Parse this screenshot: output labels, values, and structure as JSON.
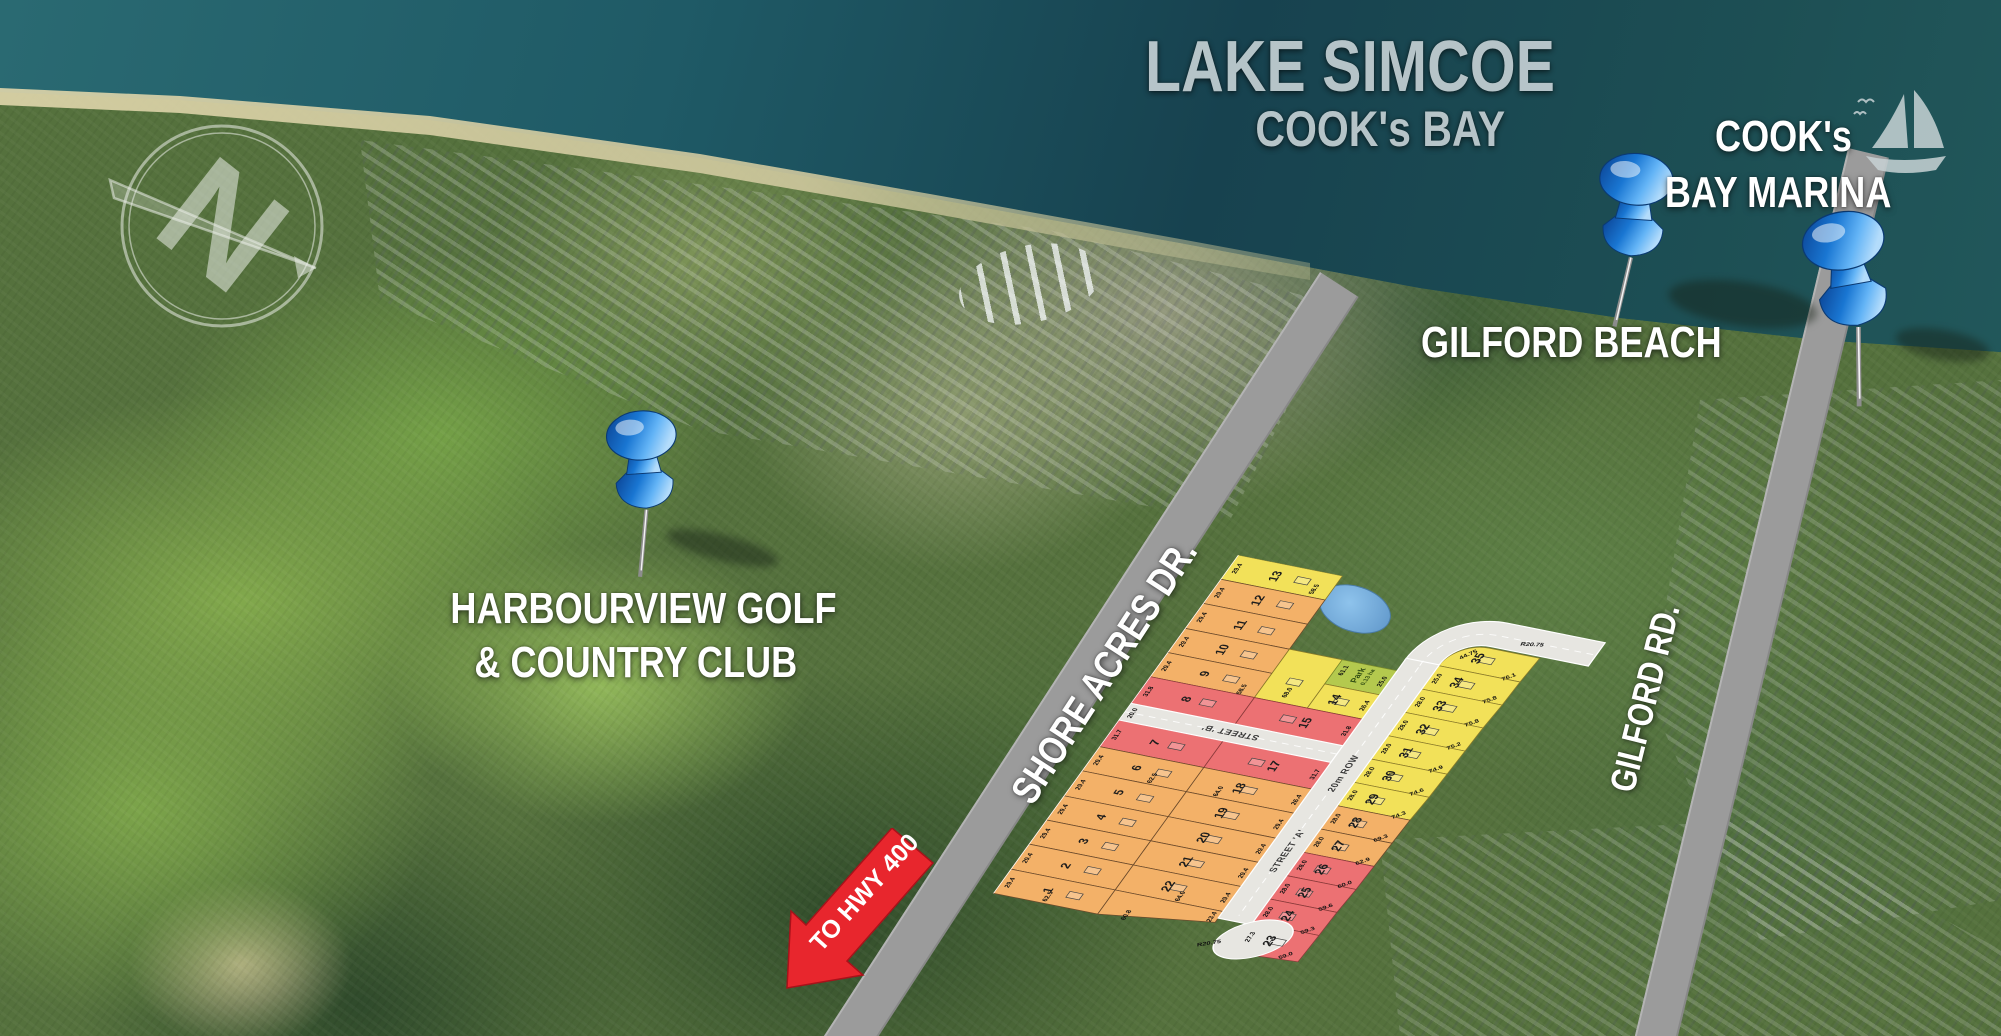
{
  "labels": {
    "lake": "LAKE SIMCOE",
    "bay": "COOK's BAY",
    "marina_l1": "COOK's",
    "marina_l2": "BAY MARINA",
    "gilford_beach": "GILFORD BEACH",
    "harbourview_l1": "HARBOURVIEW GOLF",
    "harbourview_l2": "& COUNTRY CLUB",
    "shore_acres": "SHORE ACRES DR.",
    "gilford_rd": "GILFORD RD.",
    "to_hwy": "TO HWY 400"
  },
  "compass": {
    "letter": "N"
  },
  "site_plan": {
    "street_a": "STREET 'A'",
    "street_b": "STREET 'B'",
    "row": "20m ROW",
    "radius_top": "R20.75",
    "radius_bottom": "R20.75",
    "street_b_width": "20.0",
    "park": {
      "name": "Park",
      "area": "0.13 ha",
      "dim_a": "61.1",
      "dim_b": "25.0"
    },
    "dims": {
      "d1": "58.5",
      "d2": "58.5",
      "d3": "62.5",
      "d4": "64.0",
      "d5": "62.5",
      "d6": "60.8",
      "d7": "64.0",
      "d8": "23.4",
      "d9": "68.0"
    },
    "lots": [
      {
        "n": "1",
        "front": "29.4"
      },
      {
        "n": "2",
        "front": "29.4"
      },
      {
        "n": "3",
        "front": "29.4"
      },
      {
        "n": "4",
        "front": "29.4"
      },
      {
        "n": "5",
        "front": "29.4"
      },
      {
        "n": "6",
        "front": "29.4"
      },
      {
        "n": "7",
        "front": "31.7"
      },
      {
        "n": "8",
        "front": "31.8"
      },
      {
        "n": "9",
        "front": "29.4"
      },
      {
        "n": "10",
        "front": "29.4"
      },
      {
        "n": "11",
        "front": "29.4"
      },
      {
        "n": "12",
        "front": "29.4"
      },
      {
        "n": "13",
        "front": "29.4"
      },
      {
        "n": "14",
        "front": "26.4"
      },
      {
        "n": "15",
        "front": "31.8"
      },
      {
        "n": "17",
        "front": "31.7"
      },
      {
        "n": "18",
        "front": "26.4"
      },
      {
        "n": "19",
        "front": "29.4"
      },
      {
        "n": "20",
        "front": "29.4"
      },
      {
        "n": "21",
        "front": "29.4"
      },
      {
        "n": "22",
        "front": "29.4"
      },
      {
        "n": "23",
        "front": "27.3",
        "depth": "59.0"
      },
      {
        "n": "24",
        "front": "28.0",
        "depth": "59.3"
      },
      {
        "n": "25",
        "front": "28.0",
        "depth": "59.6"
      },
      {
        "n": "26",
        "front": "28.0",
        "depth": "60.0"
      },
      {
        "n": "27",
        "front": "28.0",
        "depth": "62.9"
      },
      {
        "n": "28",
        "front": "28.0",
        "depth": "69.3"
      },
      {
        "n": "29",
        "front": "28.0",
        "depth": "74.3"
      },
      {
        "n": "30",
        "front": "28.0",
        "depth": "74.6"
      },
      {
        "n": "31",
        "front": "28.0",
        "depth": "74.9"
      },
      {
        "n": "32",
        "front": "28.0",
        "depth": "75.2"
      },
      {
        "n": "33",
        "front": "28.0",
        "depth": "75.8"
      },
      {
        "n": "34",
        "front": "25.0",
        "depth": "75.8"
      },
      {
        "n": "35",
        "front": "44.75",
        "depth": "76.1"
      }
    ]
  }
}
